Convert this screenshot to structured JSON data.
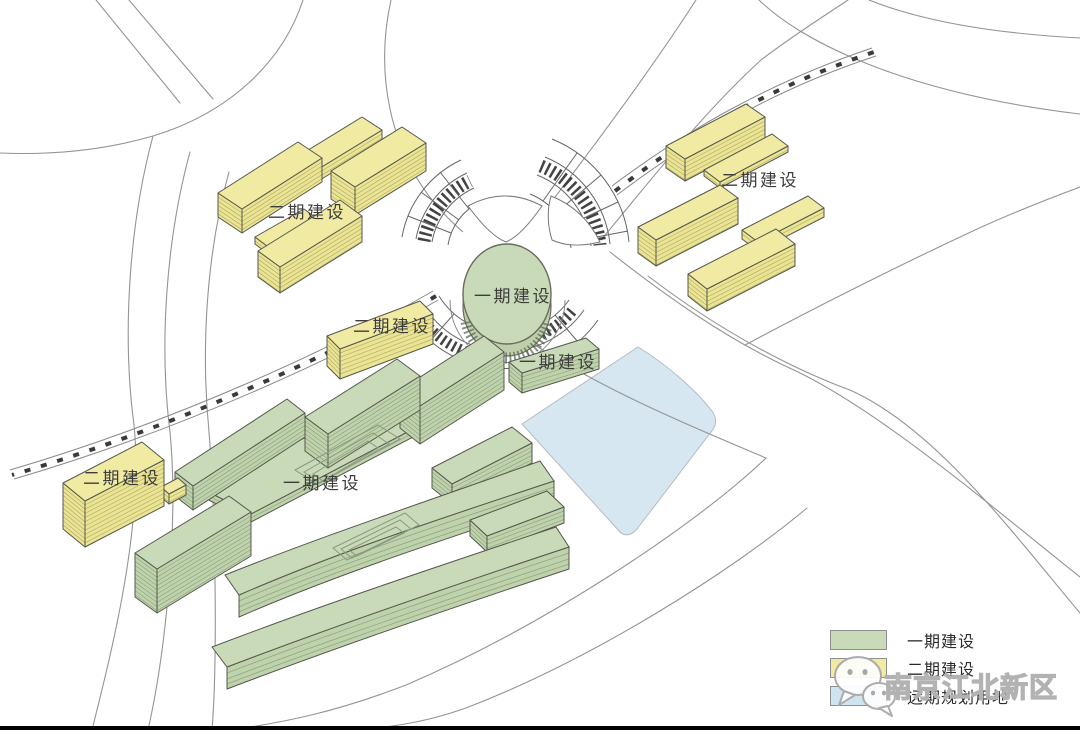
{
  "plan": {
    "building_labels": [
      {
        "text": "二期建设"
      },
      {
        "text": "二期建设"
      },
      {
        "text": "二期建设"
      },
      {
        "text": "一期建设"
      },
      {
        "text": "一期建设"
      },
      {
        "text": "二期建设"
      },
      {
        "text": "一期建设"
      }
    ]
  },
  "legend": {
    "items": [
      {
        "label": "一期建设",
        "color": "#c9dab8"
      },
      {
        "label": "二期建设",
        "color": "#f0eaa3"
      },
      {
        "label": "远期规划用地",
        "color": "#cfe4f0"
      }
    ]
  },
  "watermark": {
    "text": "南京江北新区",
    "icon": "wechat-icon"
  },
  "colors": {
    "phase1_green": "#c9dab8",
    "phase2_yellow": "#f0eaa3",
    "future_blue": "#d7e7f2",
    "road_line": "#949494",
    "building_outline": "#55584d",
    "label_text": "#3c3c3c"
  }
}
